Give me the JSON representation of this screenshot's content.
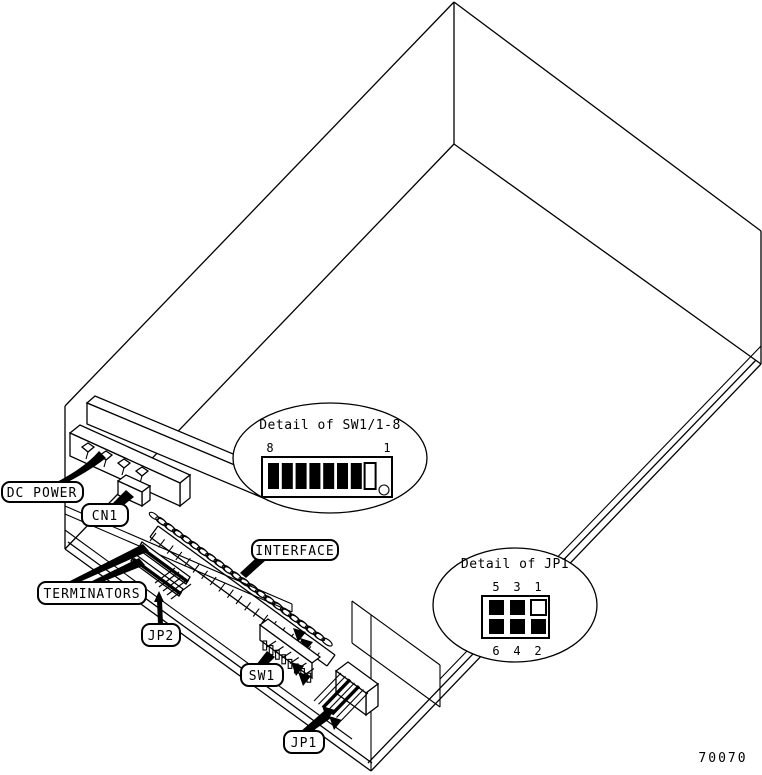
{
  "figure_number": "70070",
  "callouts": {
    "dc_power": {
      "label": "DC POWER"
    },
    "cn1": {
      "label": "CN1"
    },
    "terminators": {
      "label": "TERMINATORS"
    },
    "interface": {
      "label": "INTERFACE"
    },
    "jp2": {
      "label": "JP2"
    },
    "sw1": {
      "label": "SW1"
    },
    "jp1": {
      "label": "JP1"
    }
  },
  "details": {
    "sw1": {
      "title": "Detail of SW1/1-8",
      "left_label": "8",
      "right_label": "1",
      "switches": [
        {
          "position": 8,
          "filled": true
        },
        {
          "position": 7,
          "filled": true
        },
        {
          "position": 6,
          "filled": true
        },
        {
          "position": 5,
          "filled": true
        },
        {
          "position": 4,
          "filled": true
        },
        {
          "position": 3,
          "filled": true
        },
        {
          "position": 2,
          "filled": true
        },
        {
          "position": 1,
          "filled": false
        }
      ]
    },
    "jp1": {
      "title": "Detail of JP1",
      "top_labels": [
        "5",
        "3",
        "1"
      ],
      "bottom_labels": [
        "6",
        "4",
        "2"
      ],
      "pins": [
        {
          "pin": 5,
          "filled": true
        },
        {
          "pin": 3,
          "filled": true
        },
        {
          "pin": 1,
          "filled": false
        },
        {
          "pin": 6,
          "filled": true
        },
        {
          "pin": 4,
          "filled": true
        },
        {
          "pin": 2,
          "filled": true
        }
      ]
    }
  },
  "colors": {
    "line": "#000000",
    "background": "#ffffff"
  }
}
